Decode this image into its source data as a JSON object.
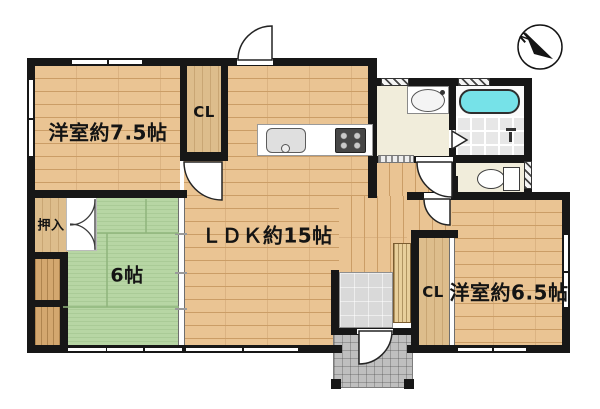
{
  "rooms": {
    "western75": {
      "label": "洋室約7.5帖"
    },
    "closetTop": {
      "label": "CL"
    },
    "ldk": {
      "label": "ＬＤＫ約15帖"
    },
    "oshiire": {
      "label": "押入"
    },
    "tatami": {
      "label": "6帖"
    },
    "closetRight": {
      "label": "CL"
    },
    "western65": {
      "label": "洋室約6.5帖"
    }
  },
  "compass": {
    "label": "N"
  },
  "colors": {
    "wall": "#171717",
    "wood": "#eac493",
    "woodline": "#cb9d66",
    "tan": "#ddbd8c",
    "tandark": "#d3a76f",
    "tatami": "#b7d6a4",
    "tatamiline": "#8fb57c",
    "cream": "#f1eddb",
    "tub": "#76e2e8"
  }
}
